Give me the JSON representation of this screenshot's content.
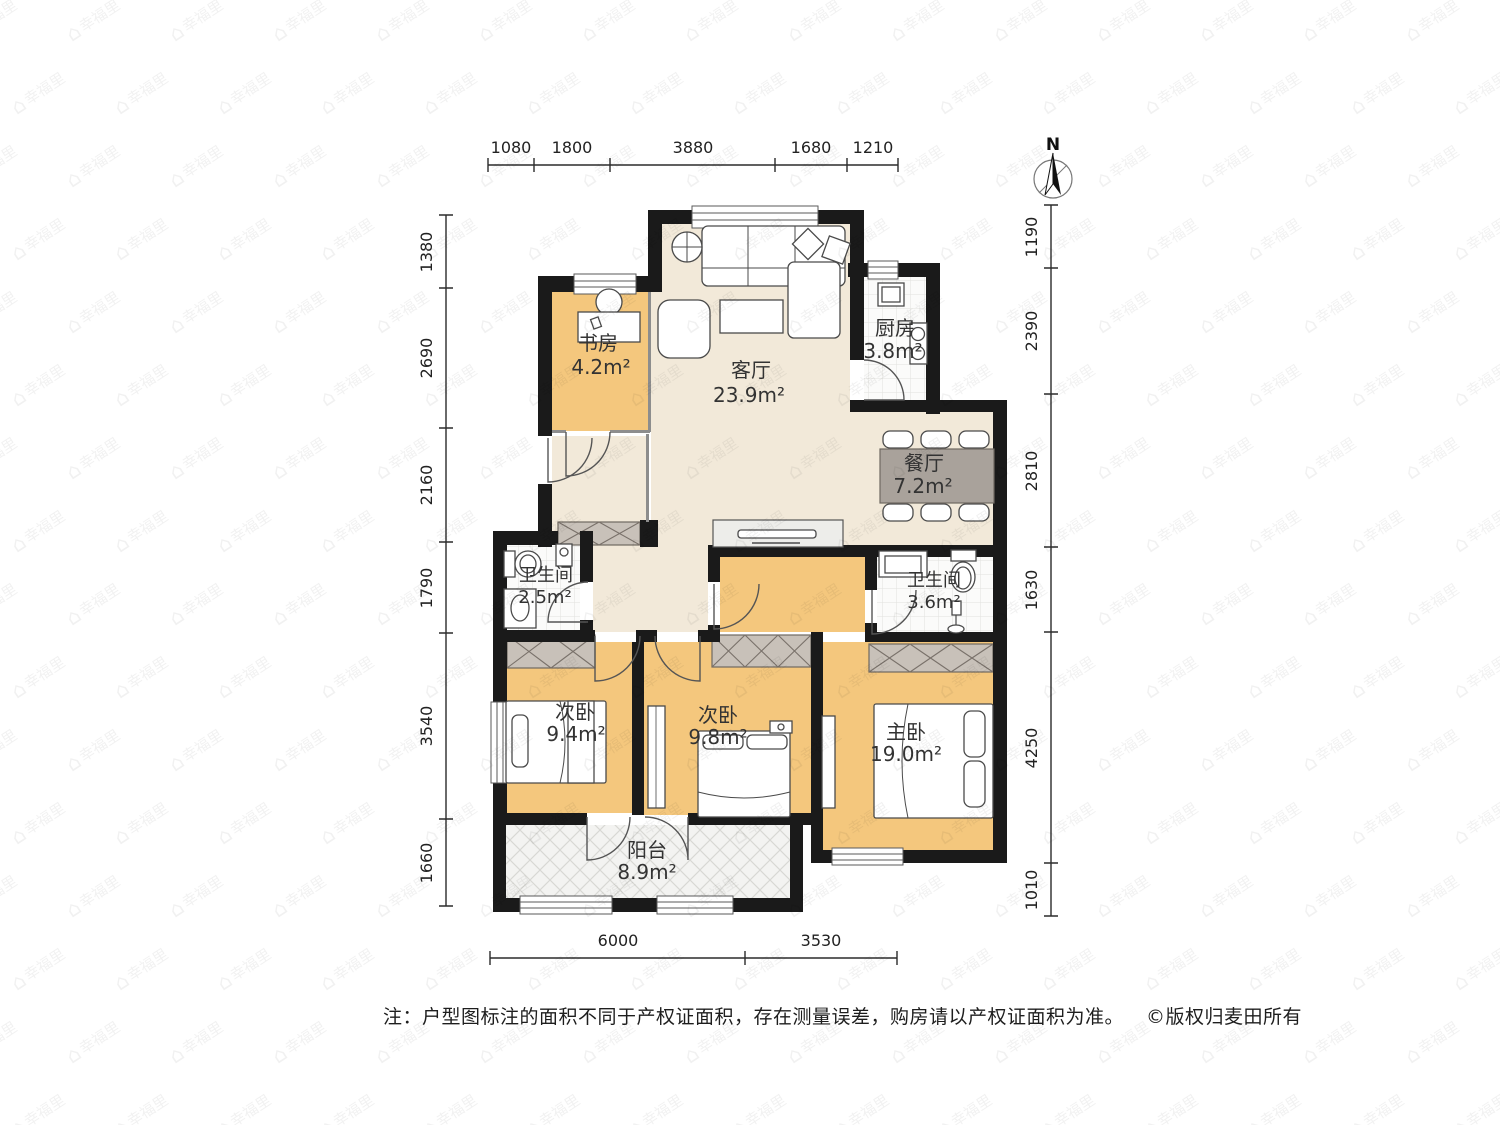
{
  "watermark": {
    "icon": "house-icon",
    "text": "幸福里"
  },
  "north": {
    "label": "N"
  },
  "dims": {
    "top": [
      "1080",
      "1800",
      "3880",
      "1680",
      "1210"
    ],
    "left": [
      "1380",
      "2690",
      "2160",
      "1790",
      "3540",
      "1660"
    ],
    "right": [
      "1190",
      "2390",
      "2810",
      "1630",
      "4250",
      "1010"
    ],
    "bottom": [
      "6000",
      "3530"
    ]
  },
  "rooms": [
    {
      "name": "书房",
      "area": "4.2m²"
    },
    {
      "name": "客厅",
      "area": "23.9m²"
    },
    {
      "name": "厨房",
      "area": "3.8m²"
    },
    {
      "name": "餐厅",
      "area": "7.2m²"
    },
    {
      "name": "卫生间",
      "area": "2.5m²"
    },
    {
      "name": "卫生间",
      "area": "3.6m²"
    },
    {
      "name": "次卧",
      "area": "9.4m²"
    },
    {
      "name": "次卧",
      "area": "9.8m²"
    },
    {
      "name": "主卧",
      "area": "19.0m²"
    },
    {
      "name": "阳台",
      "area": "8.9m²"
    }
  ],
  "note": {
    "text": "注：户型图标注的面积不同于产权证面积，存在测量误差，购房请以产权证面积为准。",
    "copyright": "©版权归麦田所有"
  },
  "colors": {
    "wall": "#1a1a1a",
    "floor_public": "#f2e9d9",
    "floor_room": "#f4c77d",
    "tile": "#fbfbfa",
    "closet": "#c8c1b9",
    "dining_table": "#a9a29b"
  }
}
